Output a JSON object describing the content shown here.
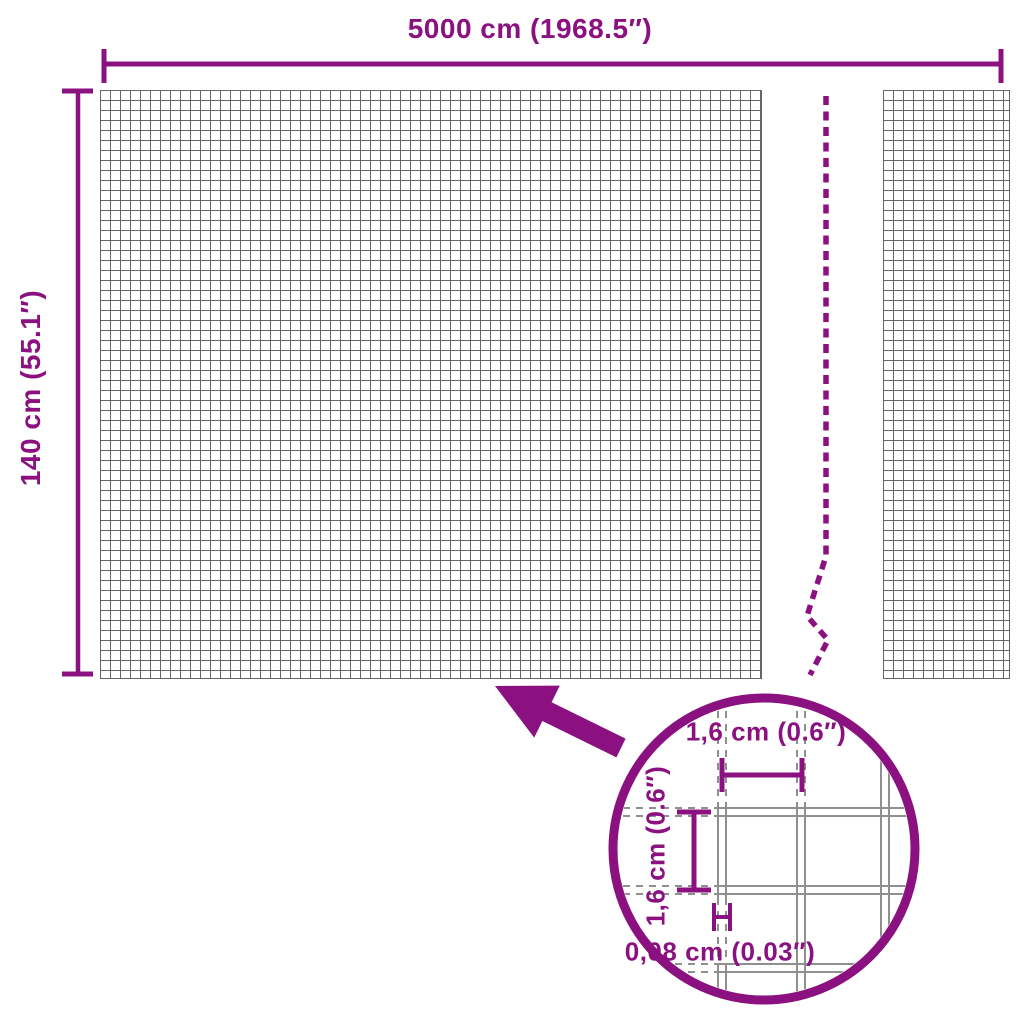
{
  "labels": {
    "overall_width": "5000 cm (1968.5″)",
    "overall_height": "140 cm (55.1″)",
    "detail_mesh_width": "1,6 cm (0.6″)",
    "detail_mesh_height": "1,6 cm (0.6″)",
    "detail_wire_thickness": "0,08 cm (0.03″)"
  },
  "colors": {
    "accent": "#8B1180",
    "mesh_line": "#666666",
    "wire_line": "#8F8F8F",
    "background": "#FFFFFF"
  },
  "icons": {
    "arrow": "zoom-arrow",
    "lens": "magnifier-circle",
    "break": "roll-break-line"
  }
}
